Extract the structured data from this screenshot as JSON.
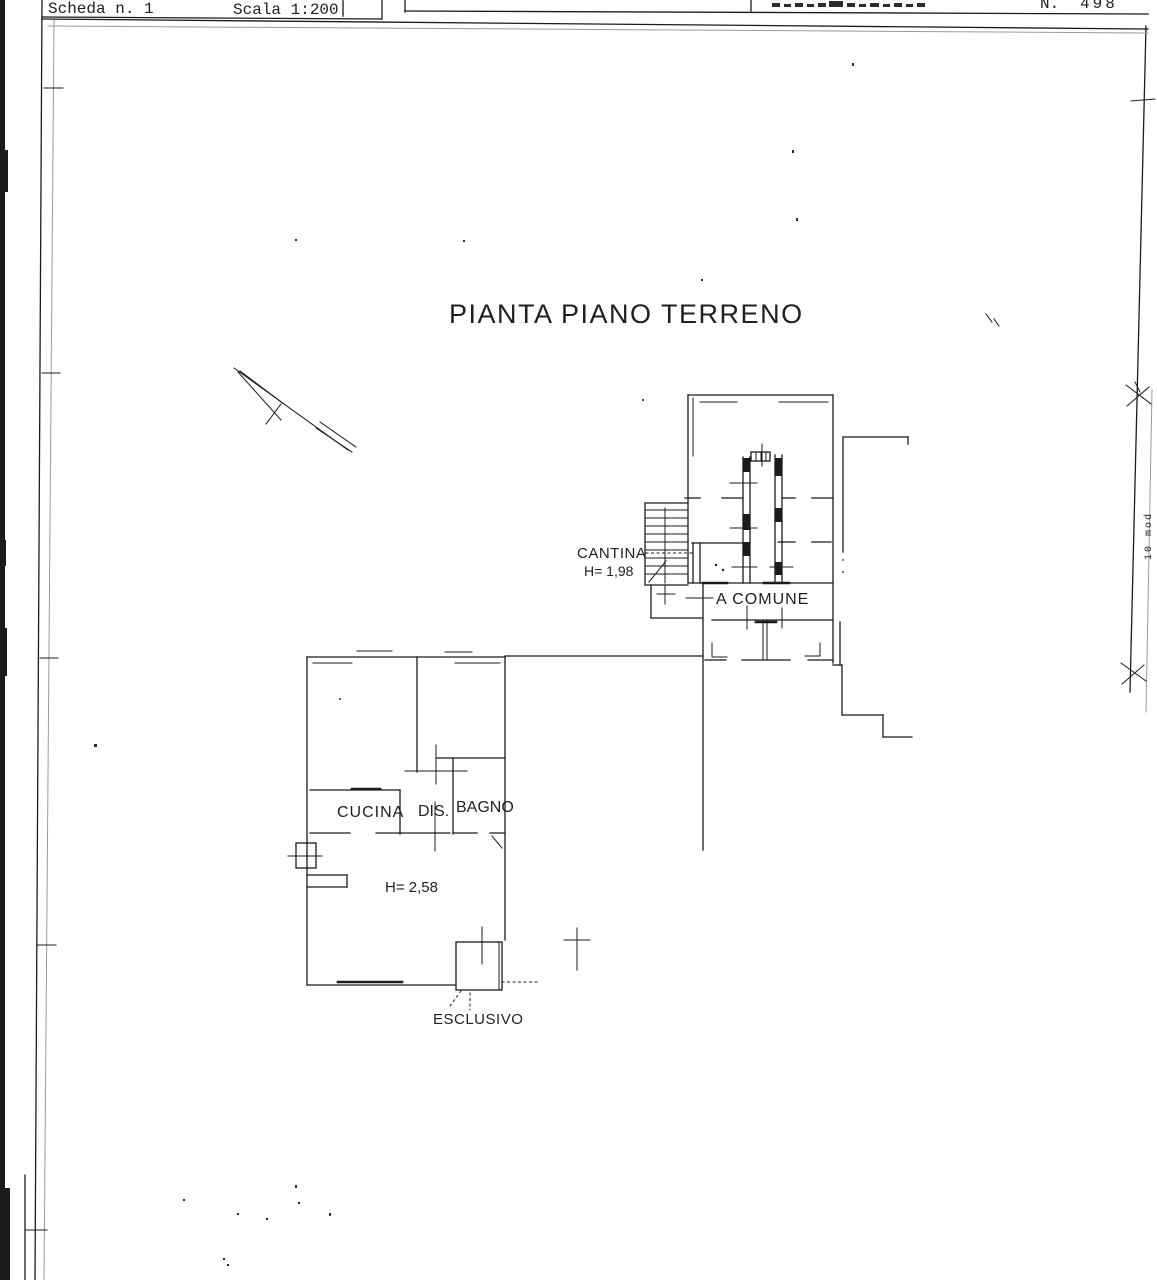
{
  "header": {
    "scheda": "Scheda n. 1",
    "scala": "Scala 1:200",
    "doc_no_prefix": "N.",
    "doc_no": "498"
  },
  "title": "PIANTA PIANO TERRENO",
  "upper_unit": {
    "stairwell_label": "CANTINA",
    "stairwell_height": "H= 1,98",
    "courtyard_label": "A COMUNE"
  },
  "lower_unit": {
    "room_kitchen": "CUCINA",
    "room_hall": "DIS.",
    "room_bath": "BAGNO",
    "ceiling_height": "H= 2,58",
    "courtyard_label": "ESCLUSIVO"
  },
  "margin_code": "10 mod",
  "colors": {
    "ink": "#1b1b1b",
    "paper": "#ffffff"
  }
}
